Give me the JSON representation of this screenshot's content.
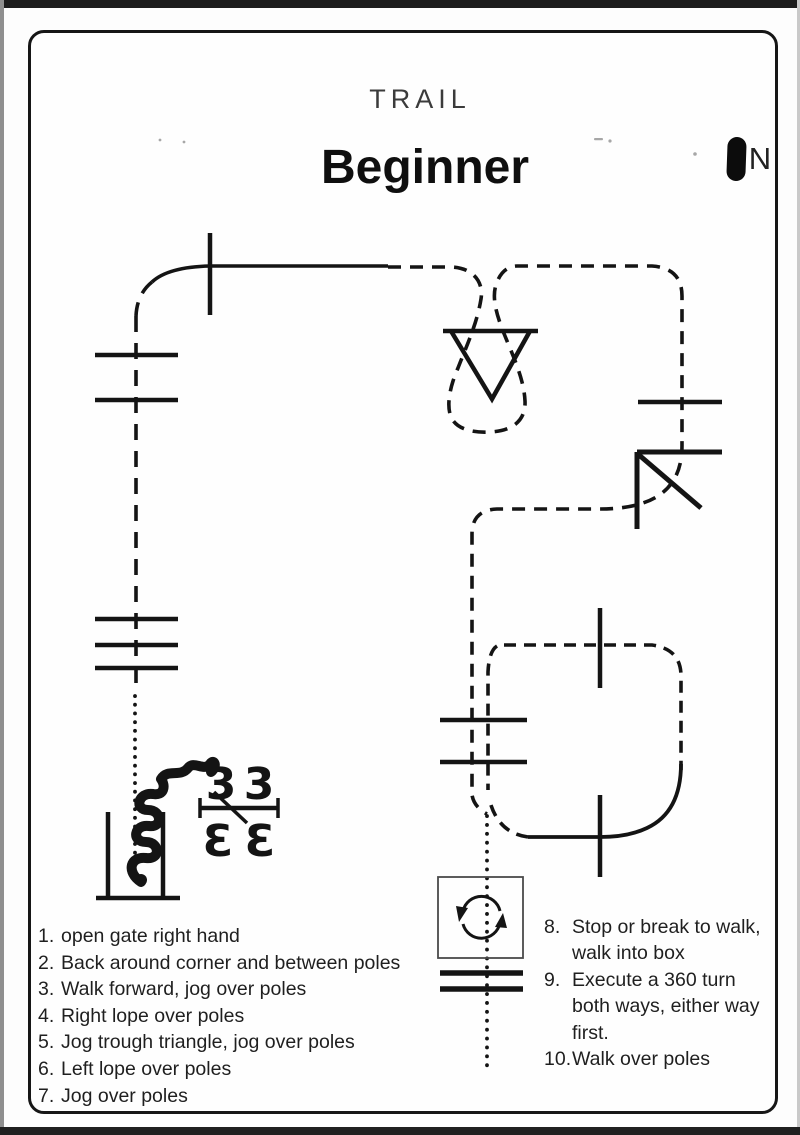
{
  "page": {
    "kicker": "TRAIL",
    "title": "Beginner"
  },
  "compass": {
    "label": "N"
  },
  "course": {
    "ink": "#141414",
    "marks": {
      "top_left": "3",
      "top_right": "3",
      "bottom_left": "Ɛ",
      "bottom_right": "Ɛ"
    }
  },
  "instructions": {
    "left": [
      {
        "n": "1.",
        "text": "open gate right hand"
      },
      {
        "n": "2.",
        "text": "Back around corner and between poles"
      },
      {
        "n": "3.",
        "text": "Walk forward, jog over poles"
      },
      {
        "n": "4.",
        "text": "Right lope over poles"
      },
      {
        "n": "5.",
        "text": "Jog trough triangle, jog over poles"
      },
      {
        "n": "6.",
        "text": "Left lope over poles"
      },
      {
        "n": "7.",
        "text": "Jog over poles"
      }
    ],
    "right": [
      {
        "n": "8.",
        "lines": [
          "Stop or break to walk,",
          "walk into box"
        ]
      },
      {
        "n": "9.",
        "lines": [
          "Execute a 360 turn",
          "both ways, either way",
          "first."
        ]
      },
      {
        "n": "10.",
        "lines": [
          "Walk over poles"
        ]
      }
    ]
  }
}
